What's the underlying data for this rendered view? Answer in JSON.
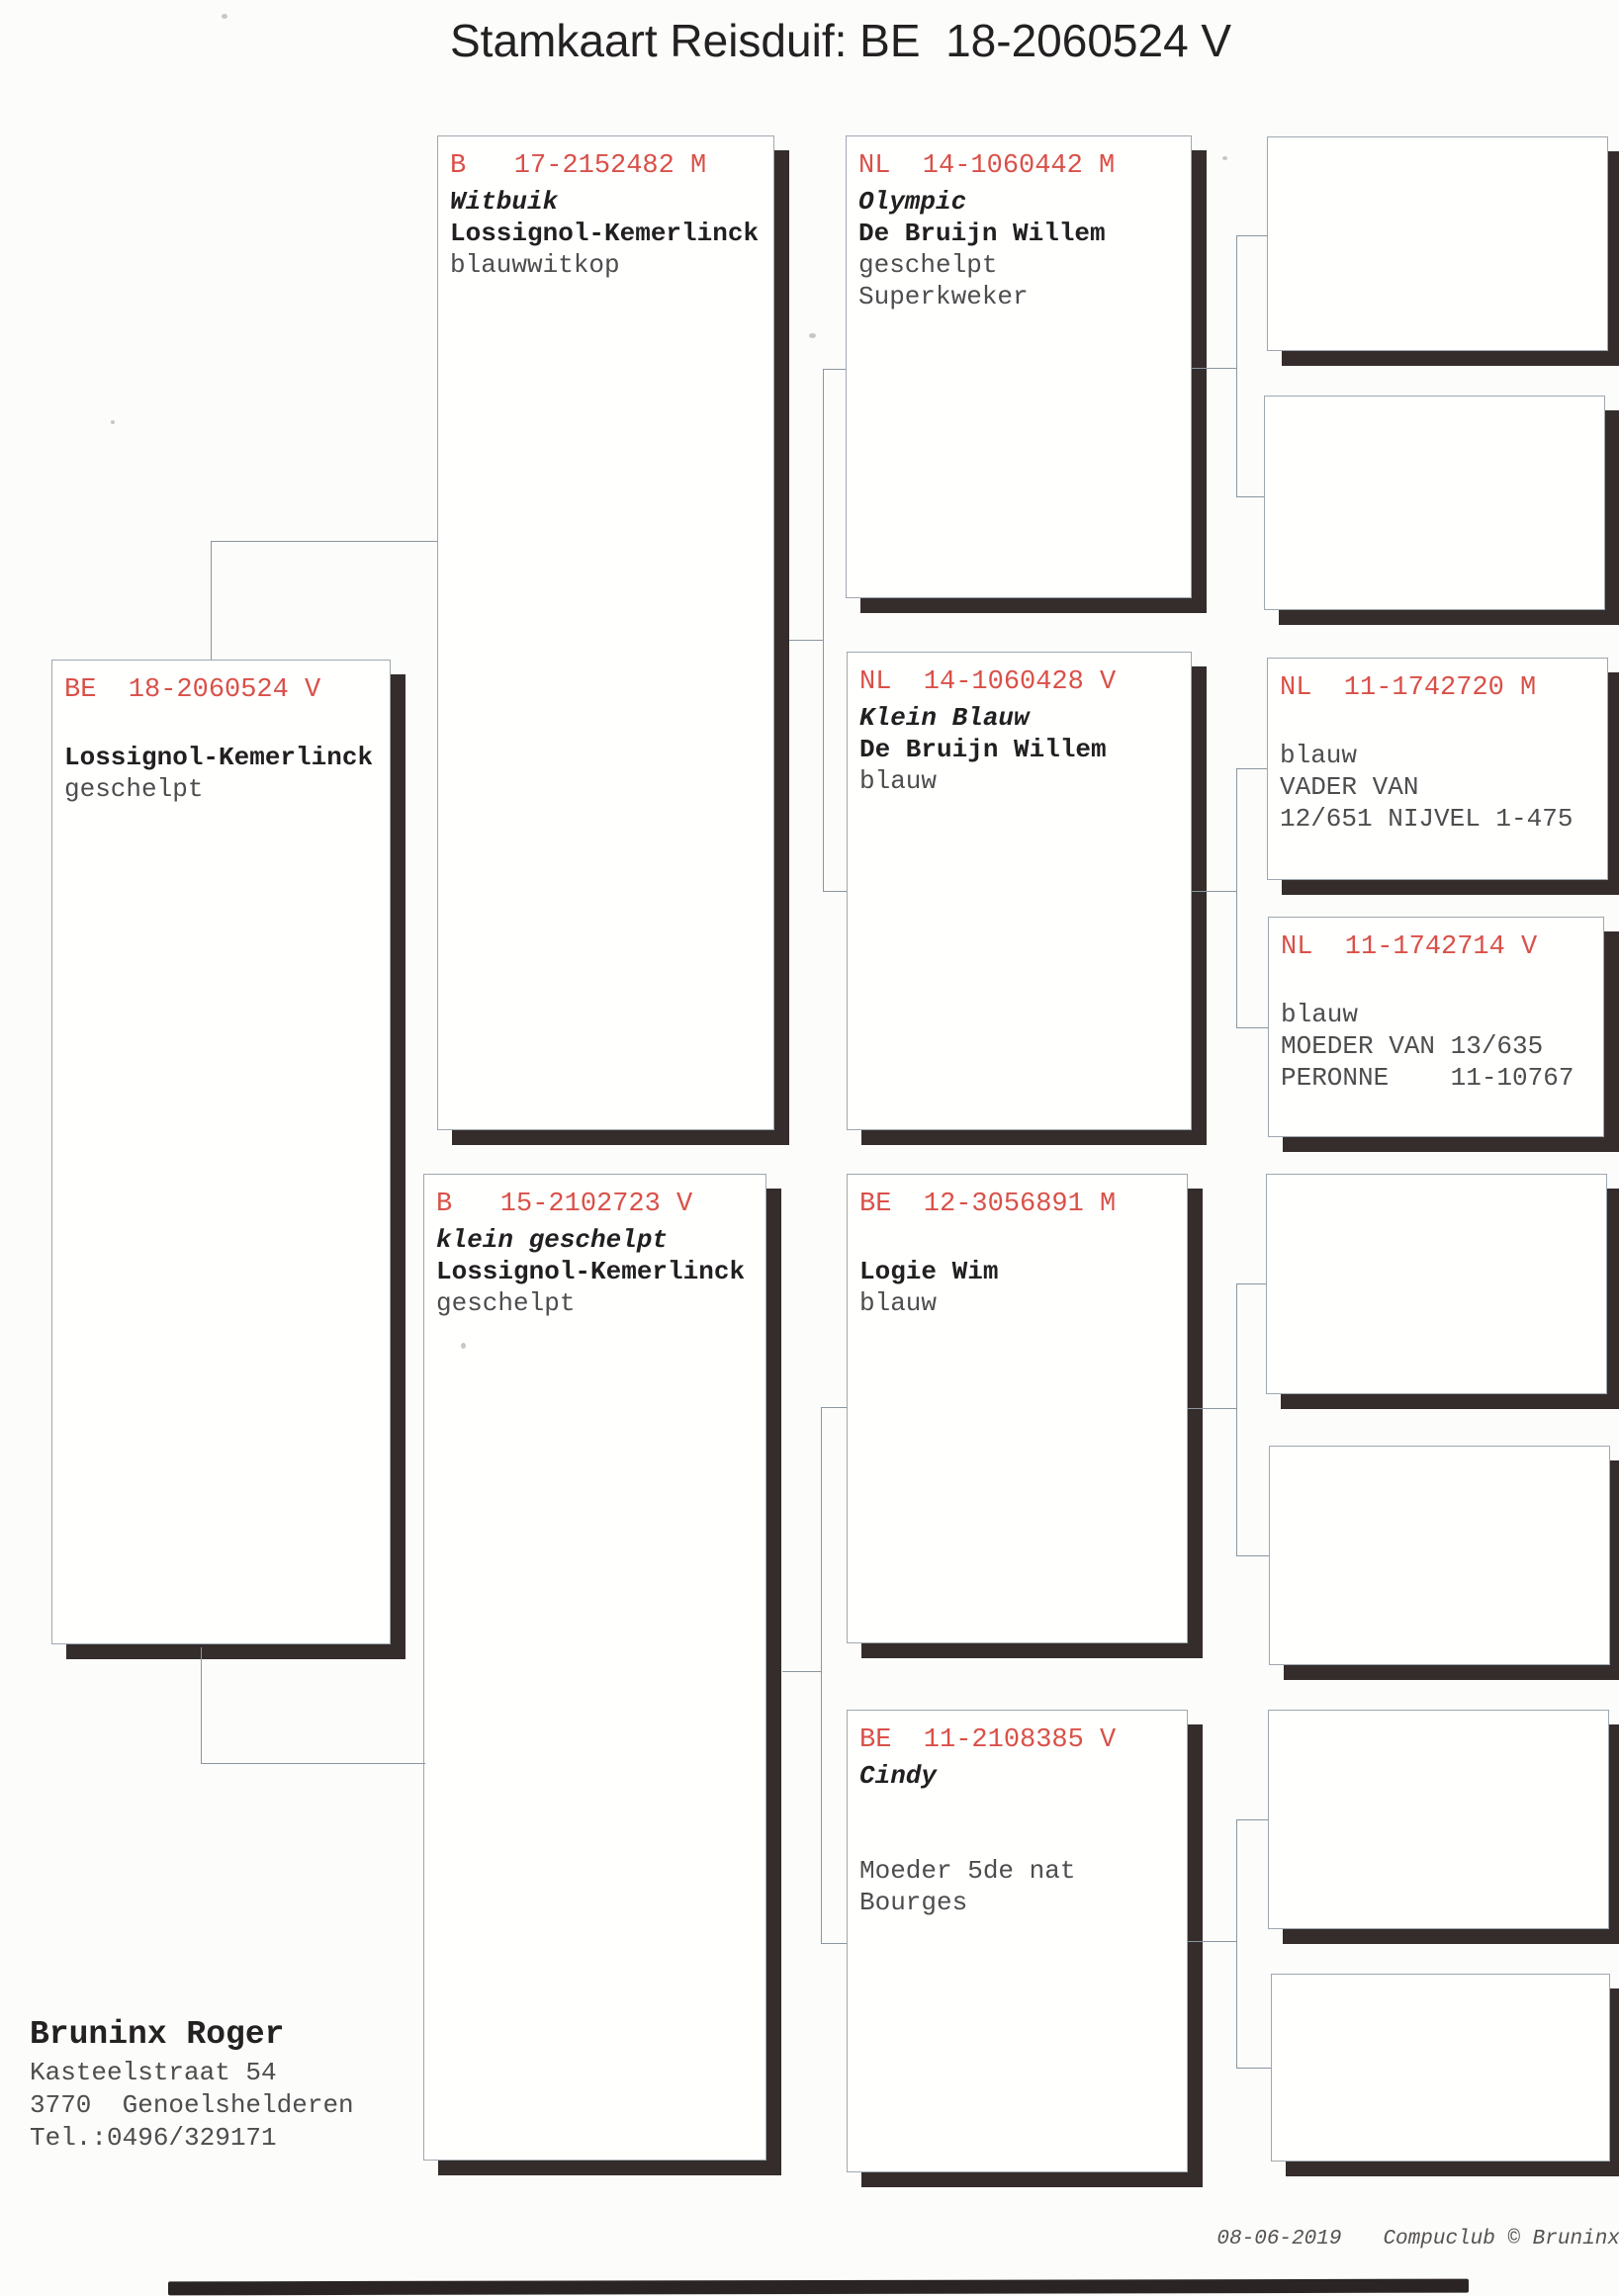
{
  "title": "Stamkaart Reisduif: BE  18-2060524 V",
  "colors": {
    "ring_red": "#d95048",
    "shadow": "#342d2c",
    "paper": "#fcfcfa",
    "connector": "#8a96a0"
  },
  "boxes": {
    "be18": {
      "ring": "BE  18-2060524 V",
      "breeder": "Lossignol-Kemerlinck",
      "color_note": "geschelpt"
    },
    "b17": {
      "ring": "B   17-2152482 M",
      "name": "Witbuik",
      "breeder": "Lossignol-Kemerlinck",
      "color_note": "blauwwitkop"
    },
    "b15": {
      "ring": "B   15-2102723 V",
      "name": "klein geschelpt",
      "breeder": "Lossignol-Kemerlinck",
      "color_note": "geschelpt"
    },
    "nl442": {
      "ring": "NL  14-1060442 M",
      "name": "Olympic",
      "breeder": "De Bruijn Willem",
      "color_note": "geschelpt",
      "note2": "Superkweker"
    },
    "nl428": {
      "ring": "NL  14-1060428 V",
      "name": "Klein Blauw",
      "breeder": "De Bruijn Willem",
      "color_note": "blauw"
    },
    "be12": {
      "ring": "BE  12-3056891 M",
      "breeder": "Logie Wim",
      "color_note": "blauw"
    },
    "be11": {
      "ring": "BE  11-2108385 V",
      "name": "Cindy",
      "note1": "Moeder 5de nat",
      "note2": "Bourges"
    },
    "nl720": {
      "ring": "NL  11-1742720 M",
      "color_note": "blauw",
      "note1": "VADER VAN",
      "note2": "12/651 NIJVEL 1-475"
    },
    "nl714": {
      "ring": "NL  11-1742714 V",
      "color_note": "blauw",
      "note1": "MOEDER VAN 13/635",
      "note2": "PERONNE    11-10767"
    }
  },
  "owner": {
    "name": "Bruninx Roger",
    "street": "Kasteelstraat 54",
    "city": "3770  Genoelshelderen",
    "phone": "Tel.:0496/329171"
  },
  "footer": {
    "date": "08-06-2019",
    "credit": "Compuclub © Bruninx Roger"
  }
}
